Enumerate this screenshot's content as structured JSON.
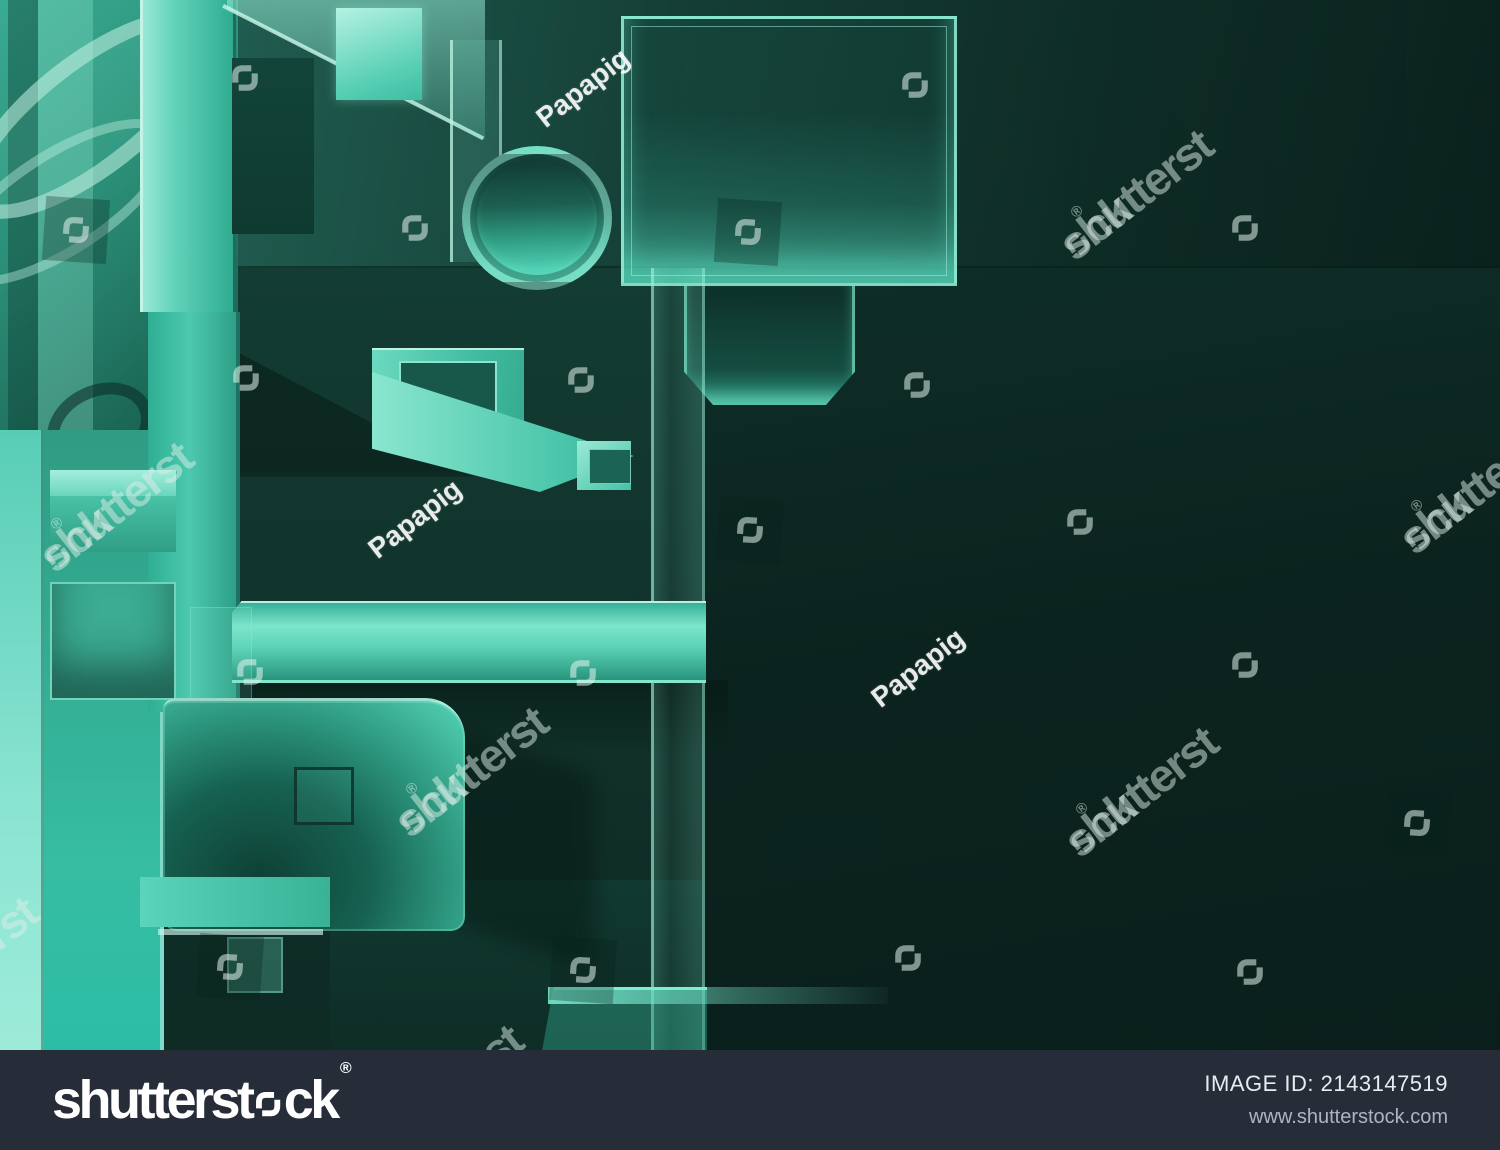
{
  "watermark": {
    "brand_part1": "shutterst",
    "brand_part2": "ck",
    "brand_full": "shutterstock",
    "reg": "®",
    "author": "Papapig"
  },
  "footer": {
    "logo_part1": "shutterst",
    "logo_part2": "ck",
    "reg": "®",
    "image_id_label": "IMAGE ID:",
    "image_id_value": "2143147519",
    "url": "www.shutterstock.com"
  },
  "colors": {
    "teal_bright": "#49cdb0",
    "teal_light": "#8fe6d2",
    "scene_dark": "#0b211d",
    "bar_background": "#262d39",
    "watermark_white": "rgba(255,255,255,0.5)"
  }
}
